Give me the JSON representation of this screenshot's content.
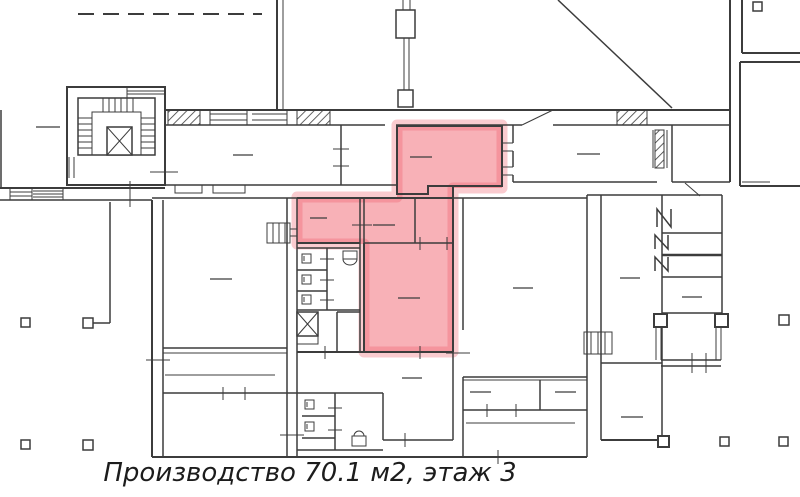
{
  "caption": {
    "text": "Производство 70.1 м2, этаж 3"
  },
  "canvas": {
    "width": 800,
    "height": 497,
    "background": "#ffffff"
  },
  "colors": {
    "wall": "#3c3c3c",
    "highlight": "#ef5360",
    "highlight_fill_opacity": 0.45,
    "highlight_halo_opacity": 0.3,
    "label_dash": "#3c3c3c"
  },
  "highlight": {
    "name": "selected-production-area",
    "points": "397,125 502,125 502,188 453,188 453,352 364,352 364,244 297,244 297,197 397,197",
    "halo_width": 11
  },
  "floorplan": {
    "walls": [
      [
        277,
        0,
        277,
        110,
        2
      ],
      [
        283,
        0,
        283,
        110,
        1
      ],
      [
        730,
        0,
        730,
        182,
        2
      ],
      [
        558,
        0,
        672,
        108,
        1.5
      ],
      [
        165,
        110,
        730,
        110,
        2
      ],
      [
        165,
        125,
        385,
        125,
        1.5
      ],
      [
        396,
        125,
        522,
        125,
        1.5
      ],
      [
        553,
        125,
        730,
        125,
        1.5
      ],
      [
        522,
        125,
        553,
        110,
        1
      ],
      [
        210,
        114,
        247,
        114,
        1
      ],
      [
        210,
        120,
        247,
        120,
        1
      ],
      [
        252,
        114,
        287,
        114,
        1
      ],
      [
        252,
        120,
        287,
        120,
        1
      ],
      [
        210,
        110,
        210,
        125,
        1
      ],
      [
        247,
        110,
        247,
        125,
        1
      ],
      [
        287,
        110,
        287,
        125,
        1
      ],
      [
        403,
        0,
        403,
        10,
        1
      ],
      [
        410,
        0,
        410,
        10,
        1
      ],
      [
        404,
        38,
        404,
        90,
        1
      ],
      [
        409,
        38,
        409,
        90,
        1
      ],
      [
        103,
        98,
        103,
        112,
        1
      ],
      [
        109,
        98,
        109,
        112,
        1
      ],
      [
        115,
        98,
        115,
        112,
        1
      ],
      [
        121,
        98,
        121,
        112,
        1
      ],
      [
        127,
        98,
        127,
        112,
        1
      ],
      [
        133,
        98,
        133,
        112,
        1
      ],
      [
        78,
        118,
        92,
        118,
        1
      ],
      [
        78,
        124,
        92,
        124,
        1
      ],
      [
        78,
        130,
        92,
        130,
        1
      ],
      [
        78,
        136,
        92,
        136,
        1
      ],
      [
        78,
        142,
        92,
        142,
        1
      ],
      [
        78,
        148,
        92,
        148,
        1
      ],
      [
        141,
        118,
        155,
        118,
        1
      ],
      [
        141,
        124,
        155,
        124,
        1
      ],
      [
        141,
        130,
        155,
        130,
        1
      ],
      [
        141,
        136,
        155,
        136,
        1
      ],
      [
        141,
        142,
        155,
        142,
        1
      ],
      [
        141,
        148,
        155,
        148,
        1
      ],
      [
        127,
        87,
        127,
        98,
        1
      ],
      [
        127,
        91,
        165,
        91,
        1
      ],
      [
        127,
        94,
        165,
        94,
        1
      ],
      [
        150,
        172,
        178,
        172,
        1
      ],
      [
        69,
        157,
        69,
        178,
        1
      ],
      [
        74,
        157,
        74,
        178,
        1
      ],
      [
        0,
        188,
        165,
        188,
        2
      ],
      [
        0,
        200,
        152,
        200,
        1.5
      ],
      [
        10,
        192,
        32,
        192,
        1
      ],
      [
        10,
        196,
        32,
        196,
        1
      ],
      [
        33,
        191,
        63,
        191,
        1
      ],
      [
        33,
        194,
        63,
        194,
        1
      ],
      [
        33,
        197,
        63,
        197,
        1
      ],
      [
        10,
        188,
        10,
        200,
        1
      ],
      [
        32,
        188,
        32,
        200,
        1
      ],
      [
        63,
        188,
        63,
        200,
        1
      ],
      [
        130,
        181,
        130,
        207,
        1
      ],
      [
        1,
        110,
        1,
        188,
        1.5
      ],
      [
        152,
        200,
        152,
        457,
        2
      ],
      [
        163,
        200,
        163,
        457,
        1.5
      ],
      [
        146,
        360,
        170,
        360,
        1
      ],
      [
        110,
        202,
        110,
        323,
        1.5
      ],
      [
        93,
        323,
        110,
        323,
        1.5
      ],
      [
        165,
        185,
        396,
        185,
        1.5
      ],
      [
        513,
        182,
        657,
        182,
        1.5
      ],
      [
        672,
        182,
        730,
        182,
        1.5
      ],
      [
        152,
        198,
        587,
        198,
        1.5
      ],
      [
        587,
        195,
        722,
        195,
        1.5
      ],
      [
        341,
        125,
        341,
        185,
        1.5
      ],
      [
        333,
        149,
        349,
        149,
        1
      ],
      [
        333,
        166,
        349,
        166,
        1
      ],
      [
        502,
        143,
        513,
        143,
        1
      ],
      [
        502,
        151,
        513,
        151,
        1
      ],
      [
        502,
        167,
        513,
        167,
        1
      ],
      [
        502,
        175,
        513,
        175,
        1
      ],
      [
        513,
        125,
        513,
        143,
        1.5
      ],
      [
        513,
        151,
        513,
        167,
        1.5
      ],
      [
        513,
        175,
        513,
        182,
        1.5
      ],
      [
        653,
        130,
        653,
        168,
        1
      ],
      [
        667,
        130,
        667,
        168,
        1
      ],
      [
        672,
        125,
        672,
        182,
        1.5
      ],
      [
        685,
        183,
        700,
        196,
        1
      ],
      [
        742,
        0,
        742,
        53,
        2
      ],
      [
        742,
        53,
        800,
        53,
        2
      ],
      [
        740,
        62,
        740,
        186,
        2
      ],
      [
        740,
        62,
        800,
        62,
        2
      ],
      [
        740,
        186,
        800,
        186,
        2
      ],
      [
        742,
        182,
        770,
        182,
        1
      ],
      [
        587,
        195,
        587,
        457,
        1.5
      ],
      [
        601,
        195,
        601,
        440,
        1.5
      ],
      [
        601,
        363,
        662,
        363,
        1.5
      ],
      [
        662,
        195,
        662,
        440,
        1.5
      ],
      [
        601,
        440,
        667,
        440,
        2
      ],
      [
        662,
        233,
        722,
        233,
        1.5
      ],
      [
        662,
        255,
        722,
        255,
        2.5
      ],
      [
        662,
        277,
        722,
        277,
        1.5
      ],
      [
        662,
        313,
        722,
        313,
        1.5
      ],
      [
        722,
        195,
        722,
        313,
        1.5
      ],
      [
        656,
        327,
        656,
        360,
        1
      ],
      [
        661,
        327,
        661,
        360,
        1
      ],
      [
        716,
        327,
        716,
        360,
        1
      ],
      [
        721,
        327,
        721,
        360,
        1
      ],
      [
        661,
        360,
        721,
        360,
        1.5
      ],
      [
        661,
        366,
        721,
        366,
        1.5
      ],
      [
        692,
        353,
        692,
        373,
        1
      ],
      [
        706,
        353,
        706,
        373,
        1
      ],
      [
        287,
        198,
        287,
        457,
        1.5
      ],
      [
        297,
        198,
        297,
        457,
        1.5
      ],
      [
        280,
        435,
        304,
        435,
        1
      ],
      [
        297,
        198,
        453,
        198,
        2
      ],
      [
        297,
        243,
        360,
        243,
        2
      ],
      [
        360,
        198,
        360,
        243,
        1.5
      ],
      [
        364,
        198,
        364,
        243,
        1.5
      ],
      [
        364,
        243,
        453,
        243,
        1.5
      ],
      [
        415,
        198,
        415,
        243,
        1.5
      ],
      [
        364,
        243,
        364,
        352,
        2
      ],
      [
        297,
        352,
        453,
        352,
        2
      ],
      [
        453,
        186,
        453,
        352,
        2
      ],
      [
        453,
        352,
        453,
        440,
        1.5
      ],
      [
        352,
        225,
        372,
        225,
        1
      ],
      [
        420,
        237,
        420,
        250,
        1
      ],
      [
        447,
        237,
        447,
        250,
        1
      ],
      [
        420,
        346,
        420,
        359,
        1
      ],
      [
        163,
        348,
        287,
        348,
        1.5
      ],
      [
        163,
        353,
        287,
        353,
        1
      ],
      [
        165,
        375,
        275,
        375,
        1
      ],
      [
        163,
        393,
        383,
        393,
        1.5
      ],
      [
        223,
        387,
        223,
        400,
        1
      ],
      [
        245,
        387,
        245,
        400,
        1
      ],
      [
        152,
        457,
        587,
        457,
        2
      ],
      [
        297,
        248,
        360,
        248,
        1.5
      ],
      [
        327,
        248,
        327,
        310,
        1.5
      ],
      [
        297,
        270,
        327,
        270,
        1.5
      ],
      [
        297,
        291,
        327,
        291,
        1.5
      ],
      [
        297,
        310,
        360,
        310,
        1.5
      ],
      [
        320,
        259,
        334,
        259,
        1
      ],
      [
        320,
        280,
        334,
        280,
        1
      ],
      [
        320,
        300,
        334,
        300,
        1
      ],
      [
        360,
        243,
        360,
        352,
        1.5
      ],
      [
        337,
        312,
        337,
        352,
        1.5
      ],
      [
        337,
        312,
        360,
        312,
        1.5
      ],
      [
        325,
        346,
        325,
        359,
        1
      ],
      [
        335,
        393,
        335,
        450,
        1.5
      ],
      [
        302,
        416,
        335,
        416,
        1.5
      ],
      [
        302,
        438,
        335,
        438,
        1.5
      ],
      [
        328,
        408,
        342,
        408,
        1
      ],
      [
        328,
        430,
        342,
        430,
        1
      ],
      [
        297,
        450,
        383,
        450,
        1.5
      ],
      [
        383,
        393,
        383,
        440,
        1.5
      ],
      [
        383,
        440,
        453,
        440,
        1.5
      ],
      [
        405,
        433,
        405,
        447,
        1
      ],
      [
        463,
        198,
        463,
        330,
        1.5
      ],
      [
        463,
        377,
        463,
        457,
        1.5
      ],
      [
        463,
        377,
        587,
        377,
        1.5
      ],
      [
        446,
        353,
        470,
        353,
        1
      ],
      [
        463,
        380,
        587,
        380,
        1
      ],
      [
        540,
        380,
        540,
        410,
        1.5
      ],
      [
        463,
        410,
        587,
        410,
        1.5
      ],
      [
        487,
        404,
        487,
        417,
        1
      ],
      [
        516,
        404,
        516,
        417,
        1
      ],
      [
        466,
        423,
        575,
        423,
        1
      ],
      [
        498,
        450,
        498,
        464,
        1
      ],
      [
        273,
        223,
        273,
        243,
        1
      ],
      [
        279,
        223,
        279,
        243,
        1
      ],
      [
        285,
        223,
        285,
        243,
        1
      ],
      [
        290,
        229,
        297,
        229,
        1
      ],
      [
        290,
        236,
        297,
        236,
        1
      ],
      [
        591,
        332,
        591,
        354,
        1
      ],
      [
        598,
        332,
        598,
        354,
        1
      ],
      [
        605,
        332,
        605,
        354,
        1
      ]
    ],
    "dashed_walls": [
      [
        78,
        14,
        262,
        14,
        2
      ]
    ],
    "rects": [
      [
        67,
        87,
        98,
        98,
        2
      ],
      [
        78,
        98,
        77,
        57,
        1.5
      ],
      [
        92,
        112,
        49,
        43,
        1
      ],
      [
        396,
        10,
        19,
        28,
        1.5
      ],
      [
        398,
        90,
        15,
        17,
        1.5
      ],
      [
        267,
        223,
        23,
        20,
        1
      ],
      [
        584,
        332,
        28,
        22,
        1
      ],
      [
        175,
        185,
        27,
        8,
        1
      ],
      [
        213,
        185,
        32,
        8,
        1
      ],
      [
        297,
        336,
        21,
        8,
        1
      ],
      [
        343,
        251,
        14,
        8,
        1
      ],
      [
        352,
        436,
        14,
        10,
        1
      ]
    ],
    "hatch_rects": [
      [
        168,
        110,
        32,
        15
      ],
      [
        297,
        110,
        33,
        15
      ],
      [
        617,
        110,
        30,
        15
      ],
      [
        655,
        130,
        9,
        38
      ]
    ],
    "x_boxes": [
      [
        107,
        127,
        25,
        28
      ],
      [
        297,
        312,
        21,
        24
      ]
    ],
    "columns": [
      [
        21,
        318,
        9,
        1.5
      ],
      [
        83,
        318,
        10,
        1.5
      ],
      [
        21,
        440,
        9,
        1.5
      ],
      [
        83,
        440,
        10,
        1.5
      ],
      [
        779,
        315,
        10,
        1.5
      ],
      [
        720,
        437,
        9,
        1.5
      ],
      [
        779,
        437,
        9,
        1.5
      ],
      [
        753,
        2,
        9,
        1.5
      ],
      [
        654,
        314,
        13,
        2
      ],
      [
        715,
        314,
        13,
        2
      ],
      [
        658,
        436,
        11,
        2
      ]
    ],
    "fixtures": [
      [
        302,
        254,
        9
      ],
      [
        302,
        275,
        9
      ],
      [
        302,
        295,
        9
      ],
      [
        305,
        400,
        9
      ],
      [
        305,
        422,
        9
      ]
    ],
    "paths": [
      {
        "d": "M397,126 L502,126 L502,186 L428,186 L428,194 L397,194 Z",
        "w": 2
      },
      {
        "d": "M343,259 a7,6 0 0 0 14,0",
        "w": 1
      },
      {
        "d": "M354,436 a5,5 0 0 1 10,0",
        "w": 1
      },
      {
        "d": "M657,227 L657,209 L671,227 L671,209",
        "w": 1.5
      },
      {
        "d": "M655,249 L655,235 L668,249 L668,235",
        "w": 1.5
      },
      {
        "d": "M655,271 L655,257 L668,271 L668,257",
        "w": 1.5
      }
    ],
    "labels": [
      [
        36,
        127,
        60
      ],
      [
        233,
        155,
        253
      ],
      [
        410,
        157,
        432
      ],
      [
        577,
        154,
        600
      ],
      [
        310,
        218,
        327
      ],
      [
        373,
        225,
        395
      ],
      [
        210,
        279,
        232
      ],
      [
        398,
        298,
        420
      ],
      [
        513,
        288,
        533
      ],
      [
        620,
        278,
        640
      ],
      [
        402,
        378,
        422
      ],
      [
        470,
        392,
        491
      ],
      [
        555,
        392,
        576
      ],
      [
        621,
        417,
        643
      ],
      [
        682,
        297,
        702
      ]
    ]
  }
}
